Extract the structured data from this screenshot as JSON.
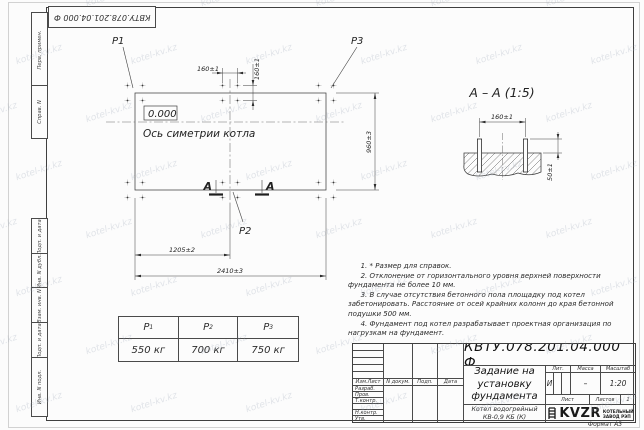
{
  "sheet": {
    "stamp_top": "КВТУ.078.201.04.000  Ф",
    "format_label": "Формат А3",
    "watermark": "kotel-kv.kz",
    "margin_labels": [
      "Перв. примен.",
      "Справ. N",
      "Подп. и дата",
      "Инв. N дубл.",
      "Взам. инв. N",
      "Подп. и дата",
      "Инв. N подл."
    ]
  },
  "plan": {
    "p1": "P1",
    "p2": "P2",
    "p3": "P3",
    "elevation": "0.000",
    "axis_label": "Ось симетрии котла",
    "dim_160h": "160±1",
    "dim_160v": "160±1",
    "dim_960": "960±3",
    "dim_1205": "1205±2",
    "dim_2410": "2410±3",
    "section_mark": "А"
  },
  "section": {
    "title": "А – А (1:5)",
    "dim_160": "160±1",
    "dim_50": "50±1"
  },
  "load_table": {
    "cols": [
      {
        "name": "P",
        "sub": "1",
        "value": "550 кг"
      },
      {
        "name": "P",
        "sub": "2",
        "value": "700 кг"
      },
      {
        "name": "P",
        "sub": "3",
        "value": "750 кг"
      }
    ]
  },
  "notes": [
    "1. * Размер для справок.",
    "2. Отклонение от горизонтального уровня верхней поверхности фундамента не более 10 мм.",
    "3. В случае отсутствия бетонного пола площадку под котел забетонировать. Расстояние от осей крайних колонн до края бетонной подушки 500 мм.",
    "4. Фундамент под котел разрабатывает проектная организация по нагрузкам на фундамент."
  ],
  "title_block": {
    "doc_number": "КВТУ.078.201.04.000  Ф",
    "title_lines": [
      "Задание на",
      "установку",
      "фундамента"
    ],
    "header_cols": [
      "Изм.Лист",
      "N докум.",
      "Подп.",
      "Дата"
    ],
    "rows": [
      "Разраб.",
      "Пров.",
      "Т.контр.",
      "",
      "Н.контр.",
      "Утв."
    ],
    "lit_label": "Лит.",
    "lit_value": "И",
    "massa_label": "Масса",
    "massa_value": "–",
    "masshtab_label": "Масштаб",
    "masshtab_value": "1:20",
    "list_label": "Лист",
    "listov_label": "Листов",
    "listov_value": "1",
    "product_lines": [
      "Котел водогрейный",
      "КВ-0,9 КБ (К)"
    ],
    "logo_text": "KVZR",
    "logo_caption": [
      "КОТЕЛЬНЫЙ",
      "ЗАВОД РЭП"
    ]
  }
}
